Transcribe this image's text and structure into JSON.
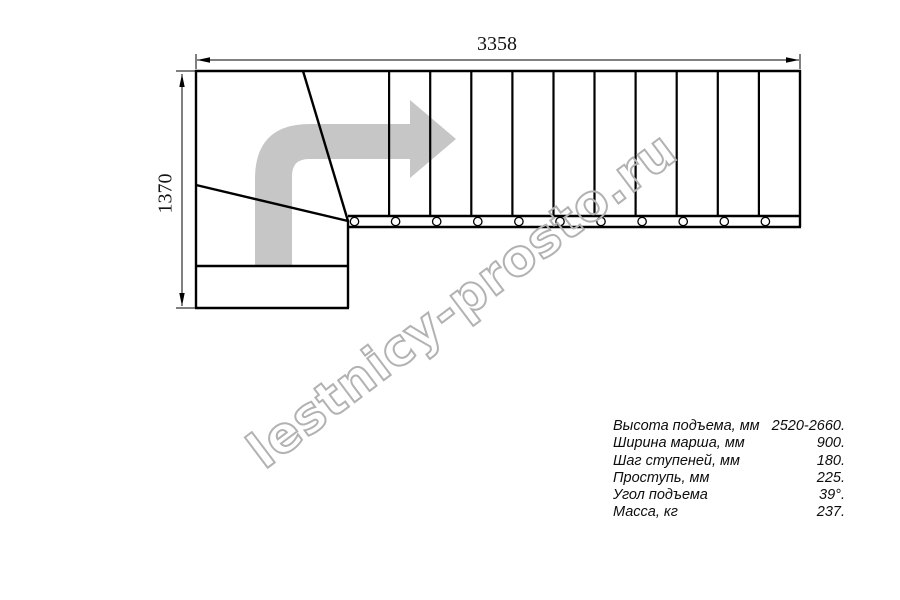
{
  "drawing": {
    "width_dimension": "3358",
    "height_dimension": "1370"
  },
  "watermark": {
    "text": "lestnicy-prosto.ru"
  },
  "specs": {
    "rows": [
      {
        "label": "Высота подъема, мм",
        "value": "2520-2660."
      },
      {
        "label": "Ширина марша, мм",
        "value": "900."
      },
      {
        "label": "Шаг ступеней, мм",
        "value": "180."
      },
      {
        "label": "Проступь, мм",
        "value": "225."
      },
      {
        "label": "Угол подъема",
        "value": "39°."
      },
      {
        "label": "Масса, кг",
        "value": "237."
      }
    ]
  },
  "colors": {
    "line_black": "#000000",
    "arrow_gray": "#c6c6c6",
    "watermark_gray": "#b2b2b2"
  }
}
